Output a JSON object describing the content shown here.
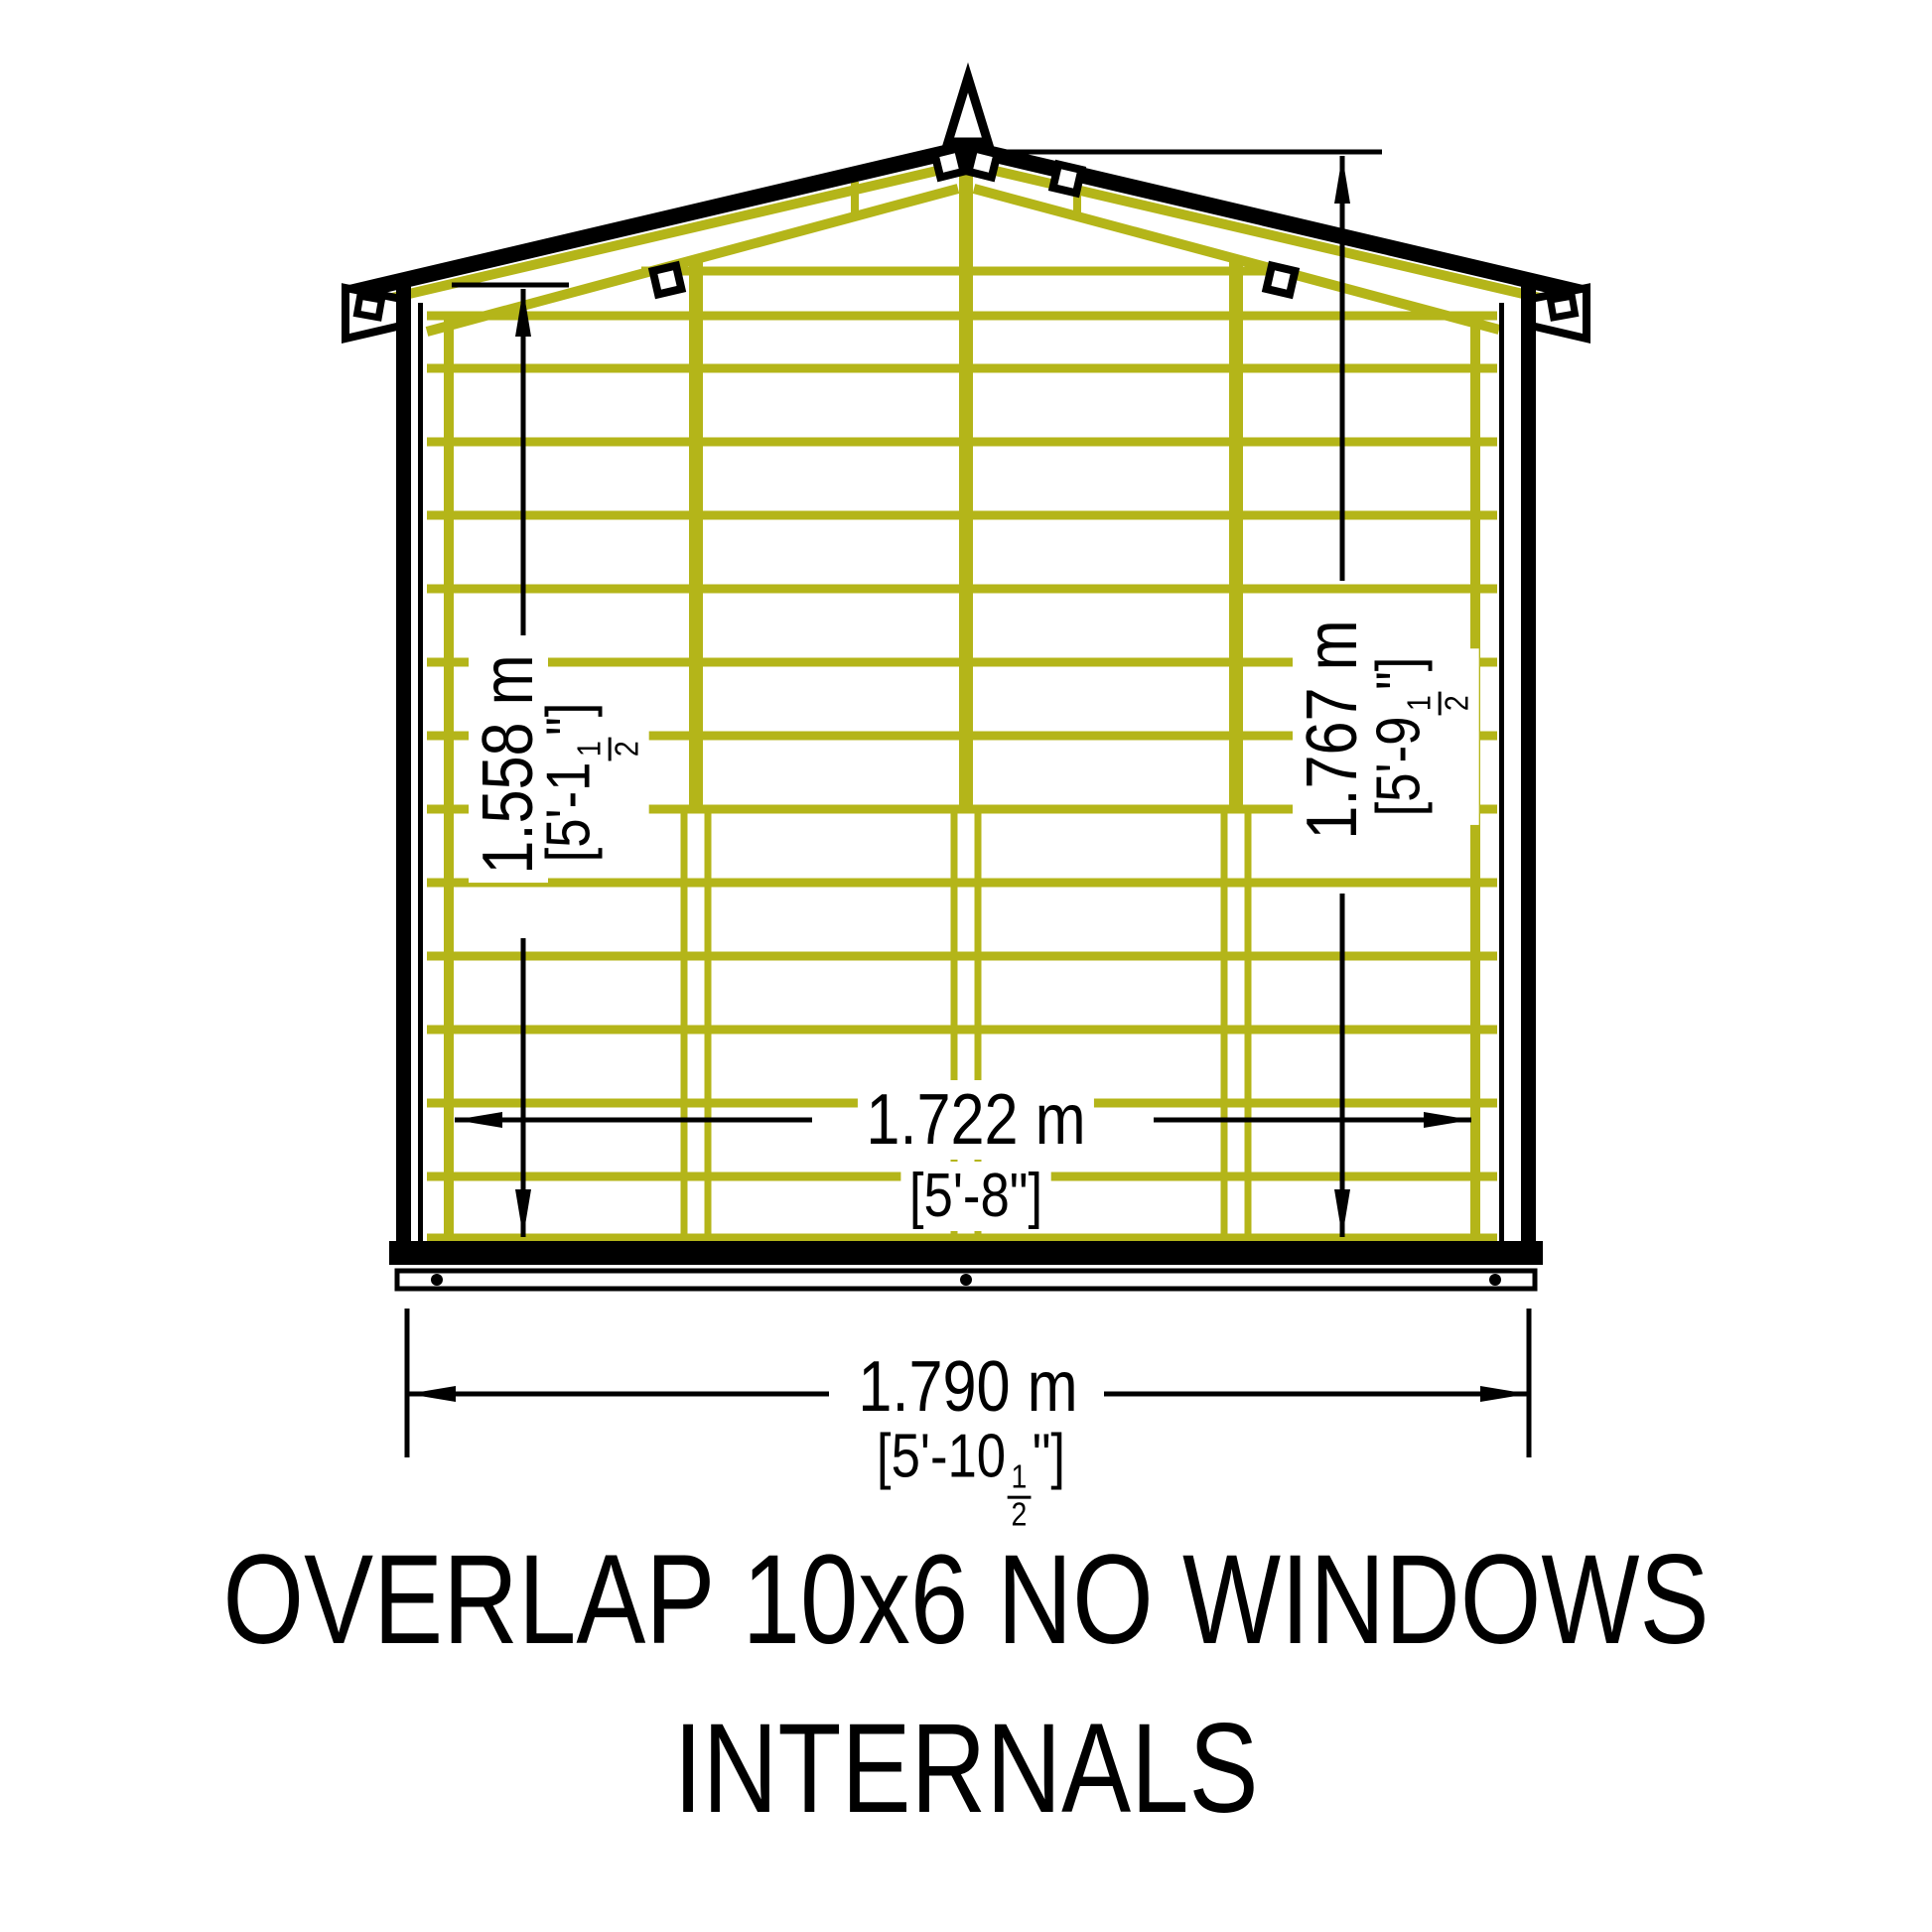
{
  "page": {
    "background": "#ffffff"
  },
  "diagram": {
    "type": "technical-elevation-drawing",
    "subject": "shed gable end internal framing",
    "title_line1": "OVERLAP 10x6 NO WINDOWS",
    "title_line2": "INTERNALS",
    "colors": {
      "outline": "#000000",
      "framing": "#b4b519",
      "dimension": "#000000",
      "background": "#ffffff"
    },
    "dimensions": {
      "left_height": {
        "metric": "1.558 m",
        "imperial": "[5'-1½\"]"
      },
      "right_height": {
        "metric": "1.767 m",
        "imperial": "[5'-9½\"]"
      },
      "inner_width": {
        "metric": "1.722 m",
        "imperial": "[5'-8\"]"
      },
      "outer_width": {
        "metric": "1.790 m",
        "imperial": "[5'-10½\"]"
      }
    }
  }
}
